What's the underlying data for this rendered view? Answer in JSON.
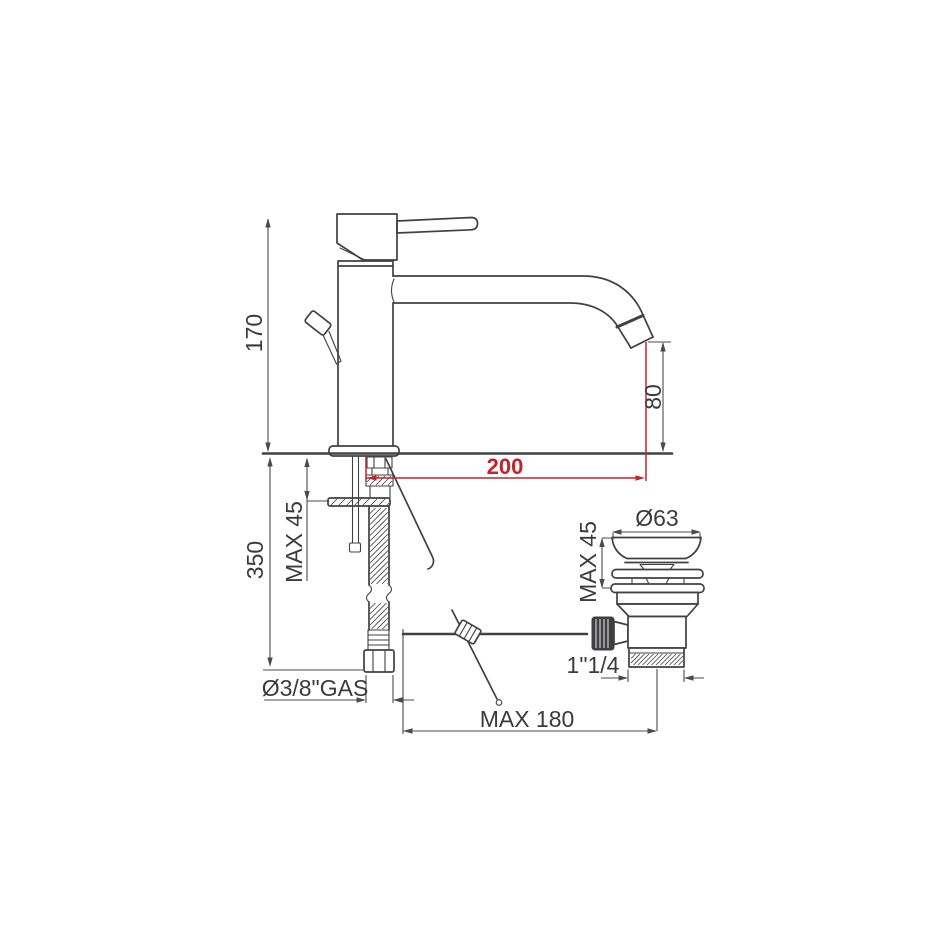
{
  "drawing": {
    "type": "basin-mixer-technical-drawing",
    "labels": {
      "overall_height": "170",
      "under_counter_depth": "350",
      "deck_thickness_max": "MAX 45",
      "spout_height": "80",
      "spout_reach": "200",
      "supply_connection": "Ø3/8\"GAS",
      "waste_flange_diameter": "Ø63",
      "waste_deck_max": "MAX 45",
      "waste_thread": "1\"1/4",
      "rod_length_max": "MAX 180"
    }
  },
  "colors": {
    "line": "#414042",
    "dim": "#4b4b4d",
    "red": "#c5222c",
    "bg": "#ffffff"
  }
}
